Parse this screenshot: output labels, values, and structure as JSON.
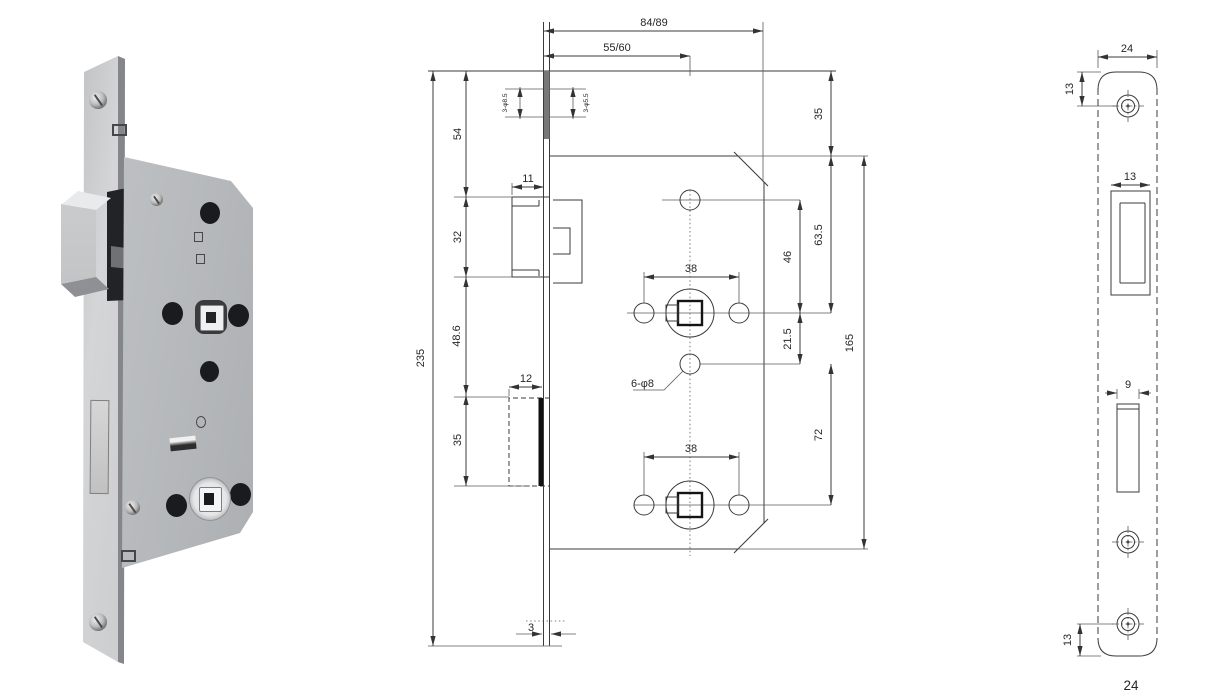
{
  "page": {
    "number": "24"
  },
  "middle": {
    "top_width": "84/89",
    "backset": "55/60",
    "face_top_offset": "54",
    "latch_height": "32",
    "mid_spacing": "48.6",
    "deadbolt_height": "35",
    "total_height": "235",
    "latch_width": "11",
    "deadbolt_width": "12",
    "faceplate_thickness": "3",
    "screw_note_left": "3-φ8.5",
    "screw_note_right": "3-φ5.5",
    "top_margin": "35",
    "case_top_to_spindle": "63.5",
    "hole_to_spindle": "46",
    "spindle_to_hole": "21.5",
    "case_height": "165",
    "hole_to_lower_follower": "72",
    "spindle_holes_span_top": "38",
    "spindle_holes_span_bottom": "38",
    "holes_note": "6-φ8"
  },
  "right": {
    "plate_width": "24",
    "top_hole_offset": "13",
    "latch_cutout_width": "13",
    "deadbolt_cutout_width": "9",
    "bottom_hole_offset": "13"
  }
}
